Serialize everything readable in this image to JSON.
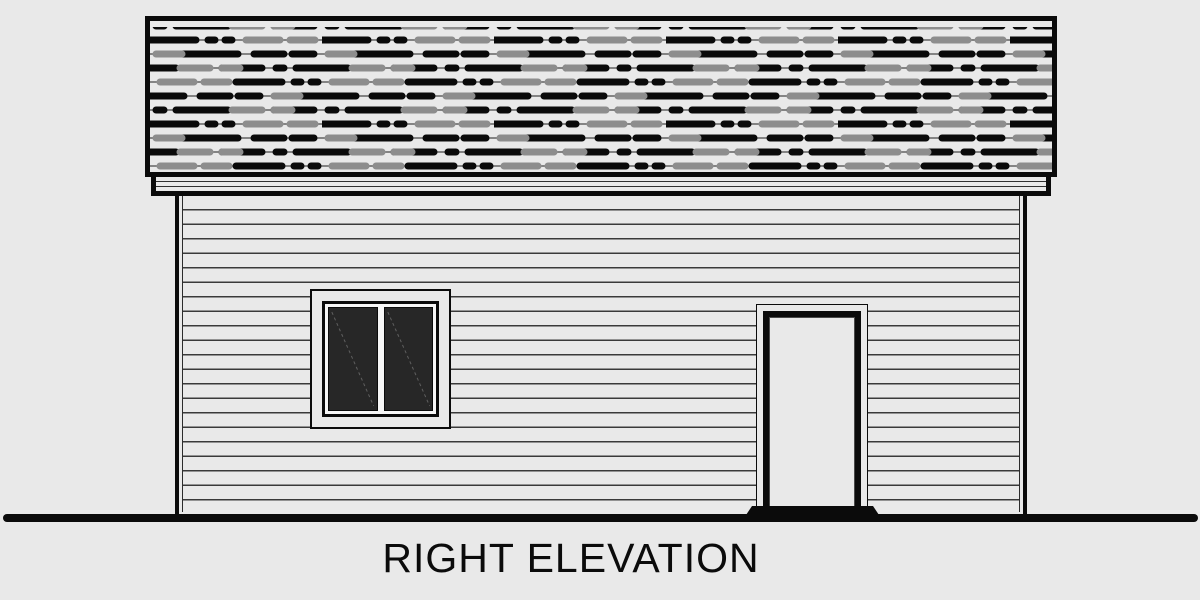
{
  "title": {
    "label": "RIGHT ELEVATION"
  },
  "scene": {
    "type": "architectural-elevation-drawing",
    "elements": [
      "shingled-roof",
      "fascia-board",
      "lap-siding-wall",
      "two-pane-window",
      "entry-door",
      "door-threshold-step",
      "ground-line"
    ]
  },
  "colors": {
    "background": "#e9e9e9",
    "ink": "#0b0b0b",
    "siding_line": "#3a3a3a",
    "shingle_black": "#0a0a0a",
    "shingle_gray": "#8d8d8d",
    "shingle_wire": "#474747",
    "pane_fill": "#272727",
    "pane_reflection": "#5f5f5f",
    "trim_light": "#f6f6f6"
  }
}
